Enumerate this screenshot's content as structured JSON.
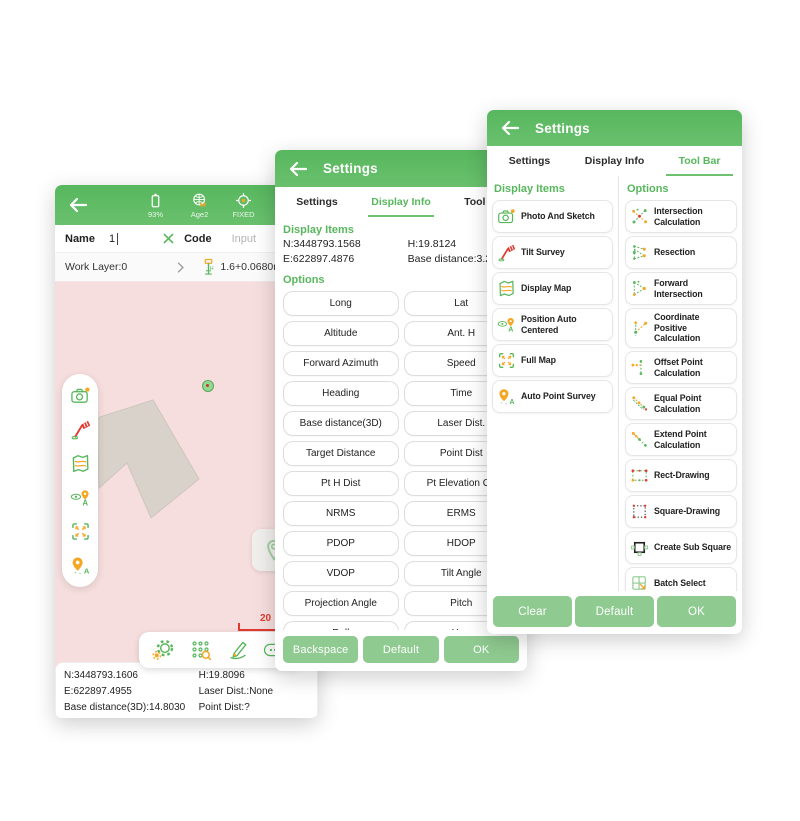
{
  "colors": {
    "accent_green": "#58b75c",
    "header_green": "#5cb962",
    "button_green": "#8fca90",
    "map_pink": "#f6dede",
    "scale_red": "#e03c31",
    "marker_orange": "#f5a623"
  },
  "icons": {
    "back_arrow": "back-arrow-icon",
    "clear_x": "clear-x-icon",
    "chevron": "chevron-right-icon",
    "antenna": "antenna-icon",
    "locate": "locate-icon",
    "position_dot": "position-dot"
  },
  "left_panel": {
    "status_items": [
      {
        "icon": "battery-icon",
        "label": "93%"
      },
      {
        "icon": "globe-icon",
        "label": "Age2"
      },
      {
        "icon": "fixed-icon",
        "label": "FIXED"
      },
      {
        "icon": "satellite-icon",
        "label": "33/48"
      }
    ],
    "name_row": {
      "name_label": "Name",
      "name_value": "1",
      "code_label": "Code",
      "code_placeholder": "Input"
    },
    "layer_row": {
      "label": "Work Layer:0",
      "antenna_value": "1.6+0.0680m"
    },
    "map": {
      "scale_label": "20",
      "side_toolbar_icons": [
        "camera-icon",
        "tilt-pole-icon",
        "map-icon",
        "position-auto-centered-icon",
        "full-map-icon",
        "auto-point-survey-icon"
      ],
      "bottom_toolbar_icons": [
        "gear-icon",
        "point-list-icon",
        "sketch-pen-icon",
        "more-icon"
      ]
    },
    "info_bar": {
      "n": "N:3448793.1606",
      "h": "H:19.8096",
      "e": "E:622897.4955",
      "laser": "Laser Dist.:None",
      "base": "Base distance(3D):14.8030",
      "point": "Point Dist:?"
    }
  },
  "middle_panel": {
    "title": "Settings",
    "tabs": [
      "Settings",
      "Display Info",
      "Tool Bar"
    ],
    "active_tab": "Display Info",
    "display_items_label": "Display Items",
    "coords": {
      "n": "N:3448793.1568",
      "h": "H:19.8124",
      "e": "E:622897.4876",
      "base": "Base distance:3.21"
    },
    "options_label": "Options",
    "option_buttons": [
      "Long",
      "Lat",
      "Altitude",
      "Ant. H",
      "Forward Azimuth",
      "Speed",
      "Heading",
      "Time",
      "Base distance(3D)",
      "Laser Dist.",
      "Target Distance",
      "Point Dist",
      "Pt H Dist",
      "Pt Elevation Off",
      "NRMS",
      "ERMS",
      "PDOP",
      "HDOP",
      "VDOP",
      "Tilt Angle",
      "Projection Angle",
      "Pitch",
      "Roll",
      "Yaw"
    ],
    "footer_buttons": [
      "Backspace",
      "Default",
      "OK"
    ]
  },
  "right_panel": {
    "title": "Settings",
    "tabs": [
      "Settings",
      "Display Info",
      "Tool Bar"
    ],
    "active_tab": "Tool Bar",
    "display_items_label": "Display Items",
    "display_items": [
      {
        "icon": "camera-icon",
        "label": "Photo And Sketch"
      },
      {
        "icon": "tilt-pole-icon",
        "label": "Tilt Survey"
      },
      {
        "icon": "map-icon",
        "label": "Display Map"
      },
      {
        "icon": "position-auto-centered-icon",
        "label": "Position Auto Centered"
      },
      {
        "icon": "full-map-icon",
        "label": "Full Map"
      },
      {
        "icon": "auto-point-survey-icon",
        "label": "Auto Point Survey"
      }
    ],
    "options_label": "Options",
    "options": [
      {
        "icon": "intersection-calculation-icon",
        "label": "Intersection Calculation"
      },
      {
        "icon": "resection-icon",
        "label": "Resection"
      },
      {
        "icon": "forward-intersection-icon",
        "label": "Forward Intersection"
      },
      {
        "icon": "coordinate-positive-calculation-icon",
        "label": "Coordinate Positive Calculation"
      },
      {
        "icon": "offset-point-calculation-icon",
        "label": "Offset Point Calculation"
      },
      {
        "icon": "equal-point-calculation-icon",
        "label": "Equal Point Calculation"
      },
      {
        "icon": "extend-point-calculation-icon",
        "label": "Extend Point Calculation"
      },
      {
        "icon": "rect-drawing-icon",
        "label": "Rect-Drawing"
      },
      {
        "icon": "square-drawing-icon",
        "label": "Square-Drawing"
      },
      {
        "icon": "create-sub-square-icon",
        "label": "Create Sub Square"
      },
      {
        "icon": "batch-select-icon",
        "label": "Batch Select"
      },
      {
        "icon": "3d-view-plot-icon",
        "label": "3D View Plot"
      }
    ],
    "footer_buttons": [
      "Clear",
      "Default",
      "OK"
    ]
  }
}
